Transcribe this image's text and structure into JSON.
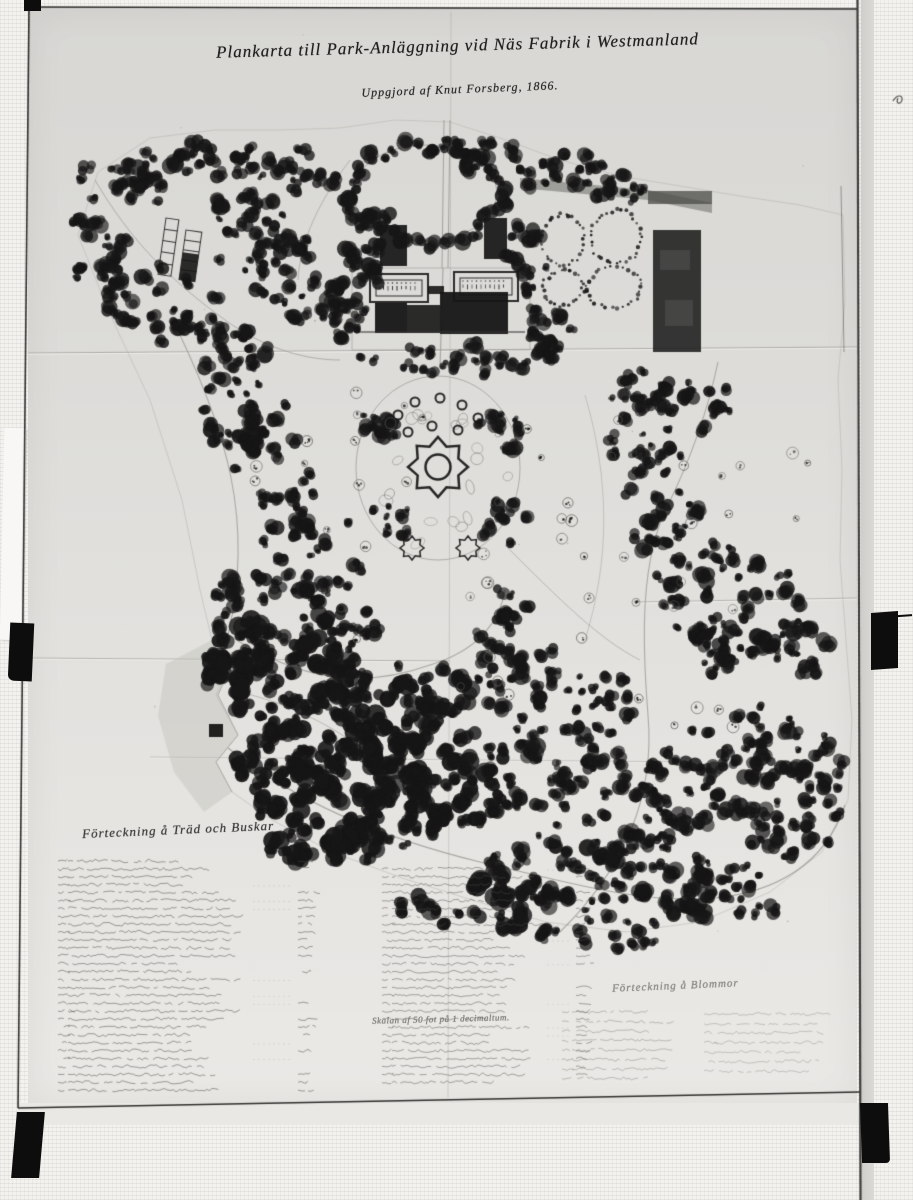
{
  "map": {
    "title_line1": "Plankarta till Park-Anläggning vid Näs Fabrik i Westmanland",
    "title_line2": "Uppgjord af Knut Forsberg, 1866.",
    "scale_note": "Skalan af 50 fot på 1 decimaltum.",
    "legend_trees": {
      "title": "Förteckning å Träd och Buskar",
      "rows_left": 30,
      "rows_right": 28
    },
    "legend_flowers": {
      "title": "Förteckning å Blommor",
      "rows_left": 8,
      "rows_right": 7
    }
  },
  "colors": {
    "ink": "#161616",
    "paper_top": "#d8d7d4",
    "paper_bottom": "#ebe9e6",
    "tape": "#0d0d0d"
  }
}
